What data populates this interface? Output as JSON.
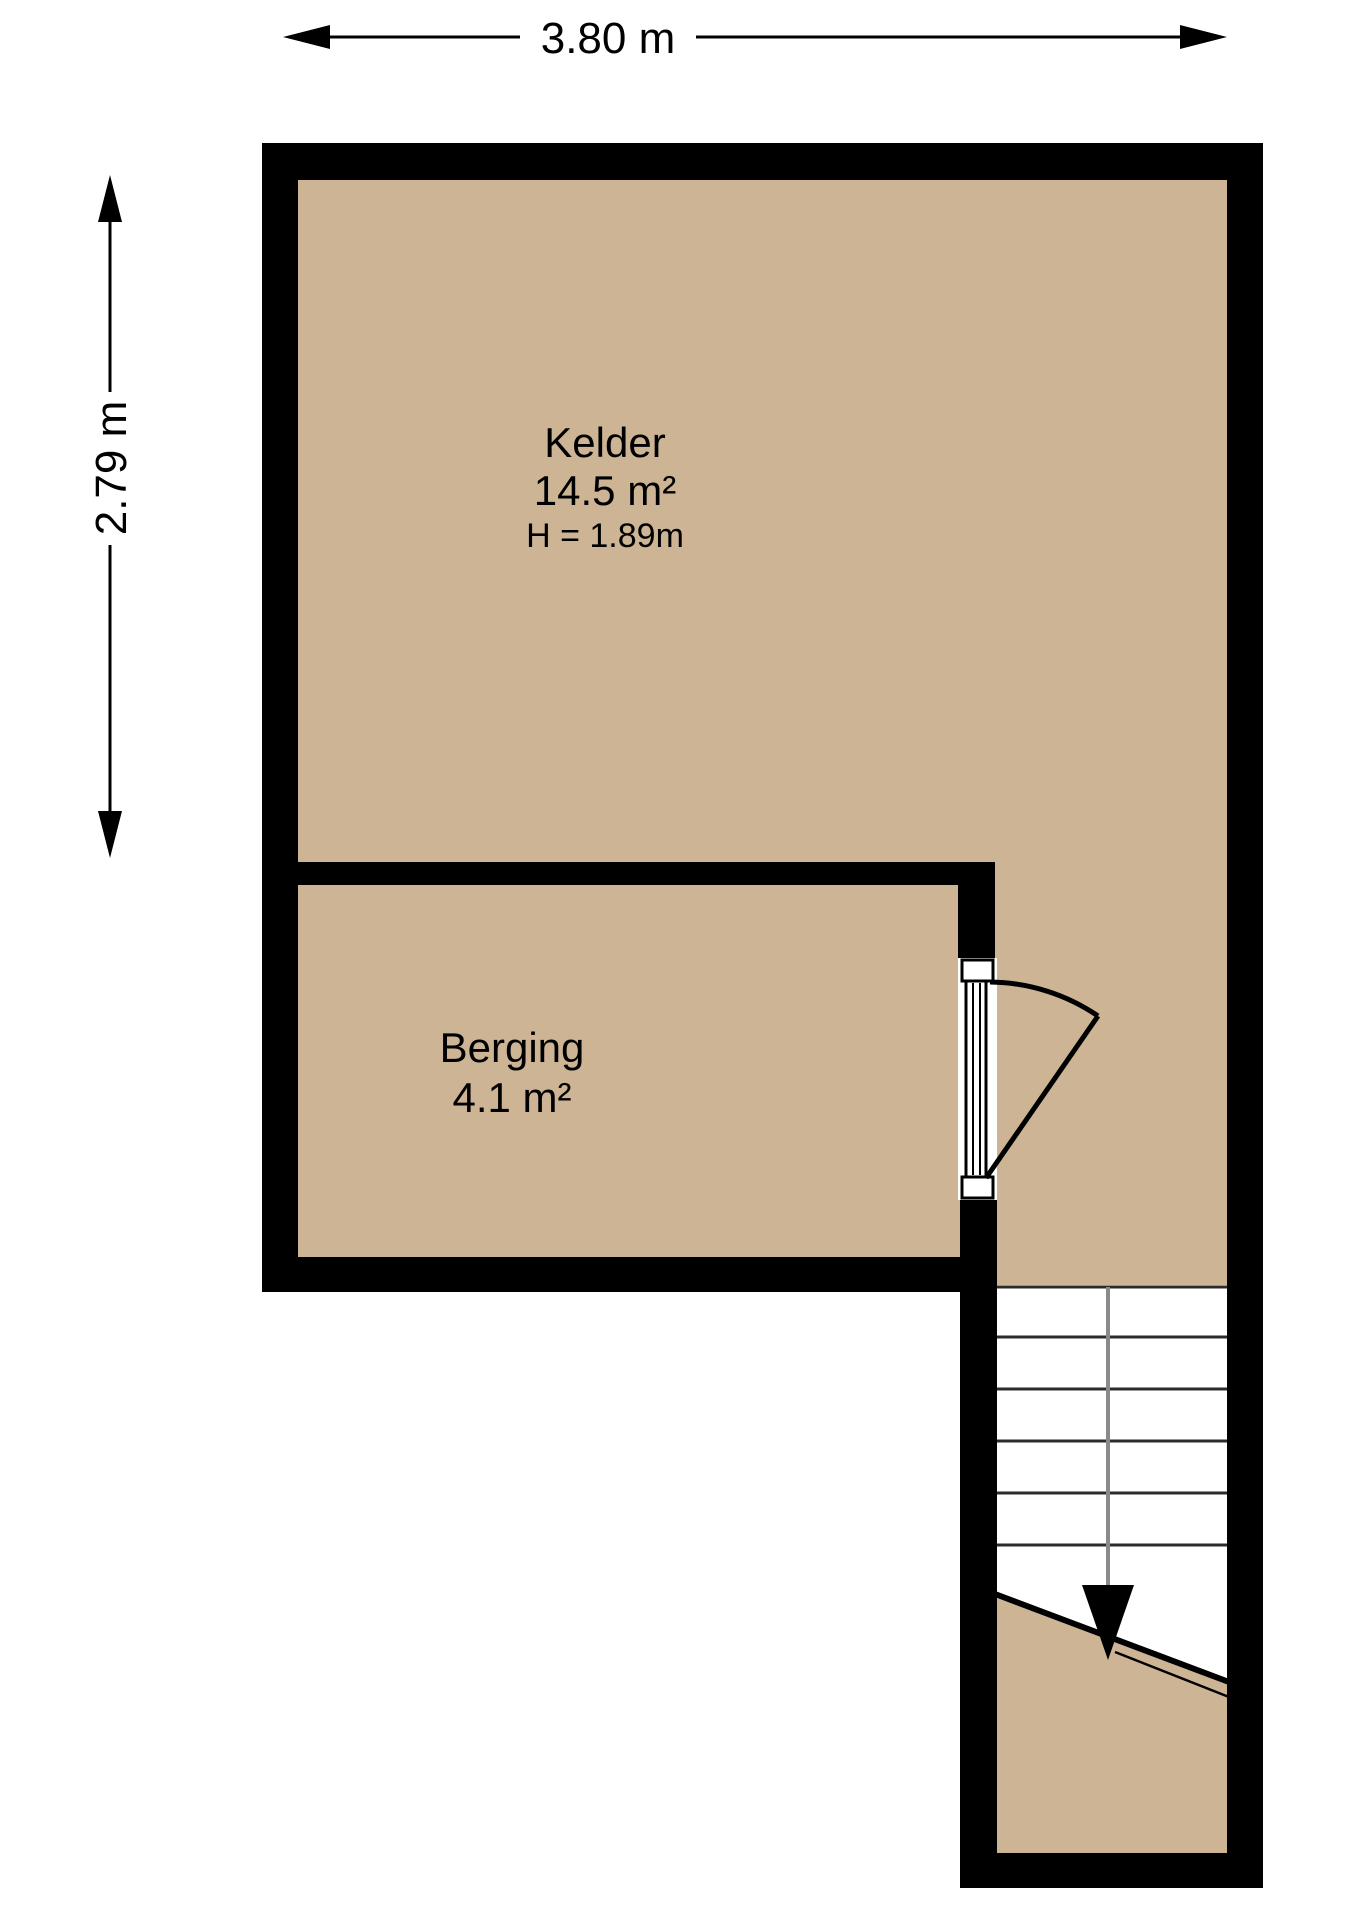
{
  "floorplan": {
    "dimension_width": {
      "label": "3.80 m"
    },
    "dimension_height": {
      "label": "2.79 m"
    },
    "rooms": [
      {
        "name": "Kelder",
        "area": "14.5 m²",
        "ceiling_height": "H = 1.89m"
      },
      {
        "name": "Berging",
        "area": "4.1 m²"
      }
    ],
    "colors": {
      "floor": "#ccb494",
      "wall": "#000000",
      "walk_line": "#8a8a8a",
      "tread_line": "#2b2b2b",
      "background": "#ffffff",
      "text": "#000000"
    }
  }
}
